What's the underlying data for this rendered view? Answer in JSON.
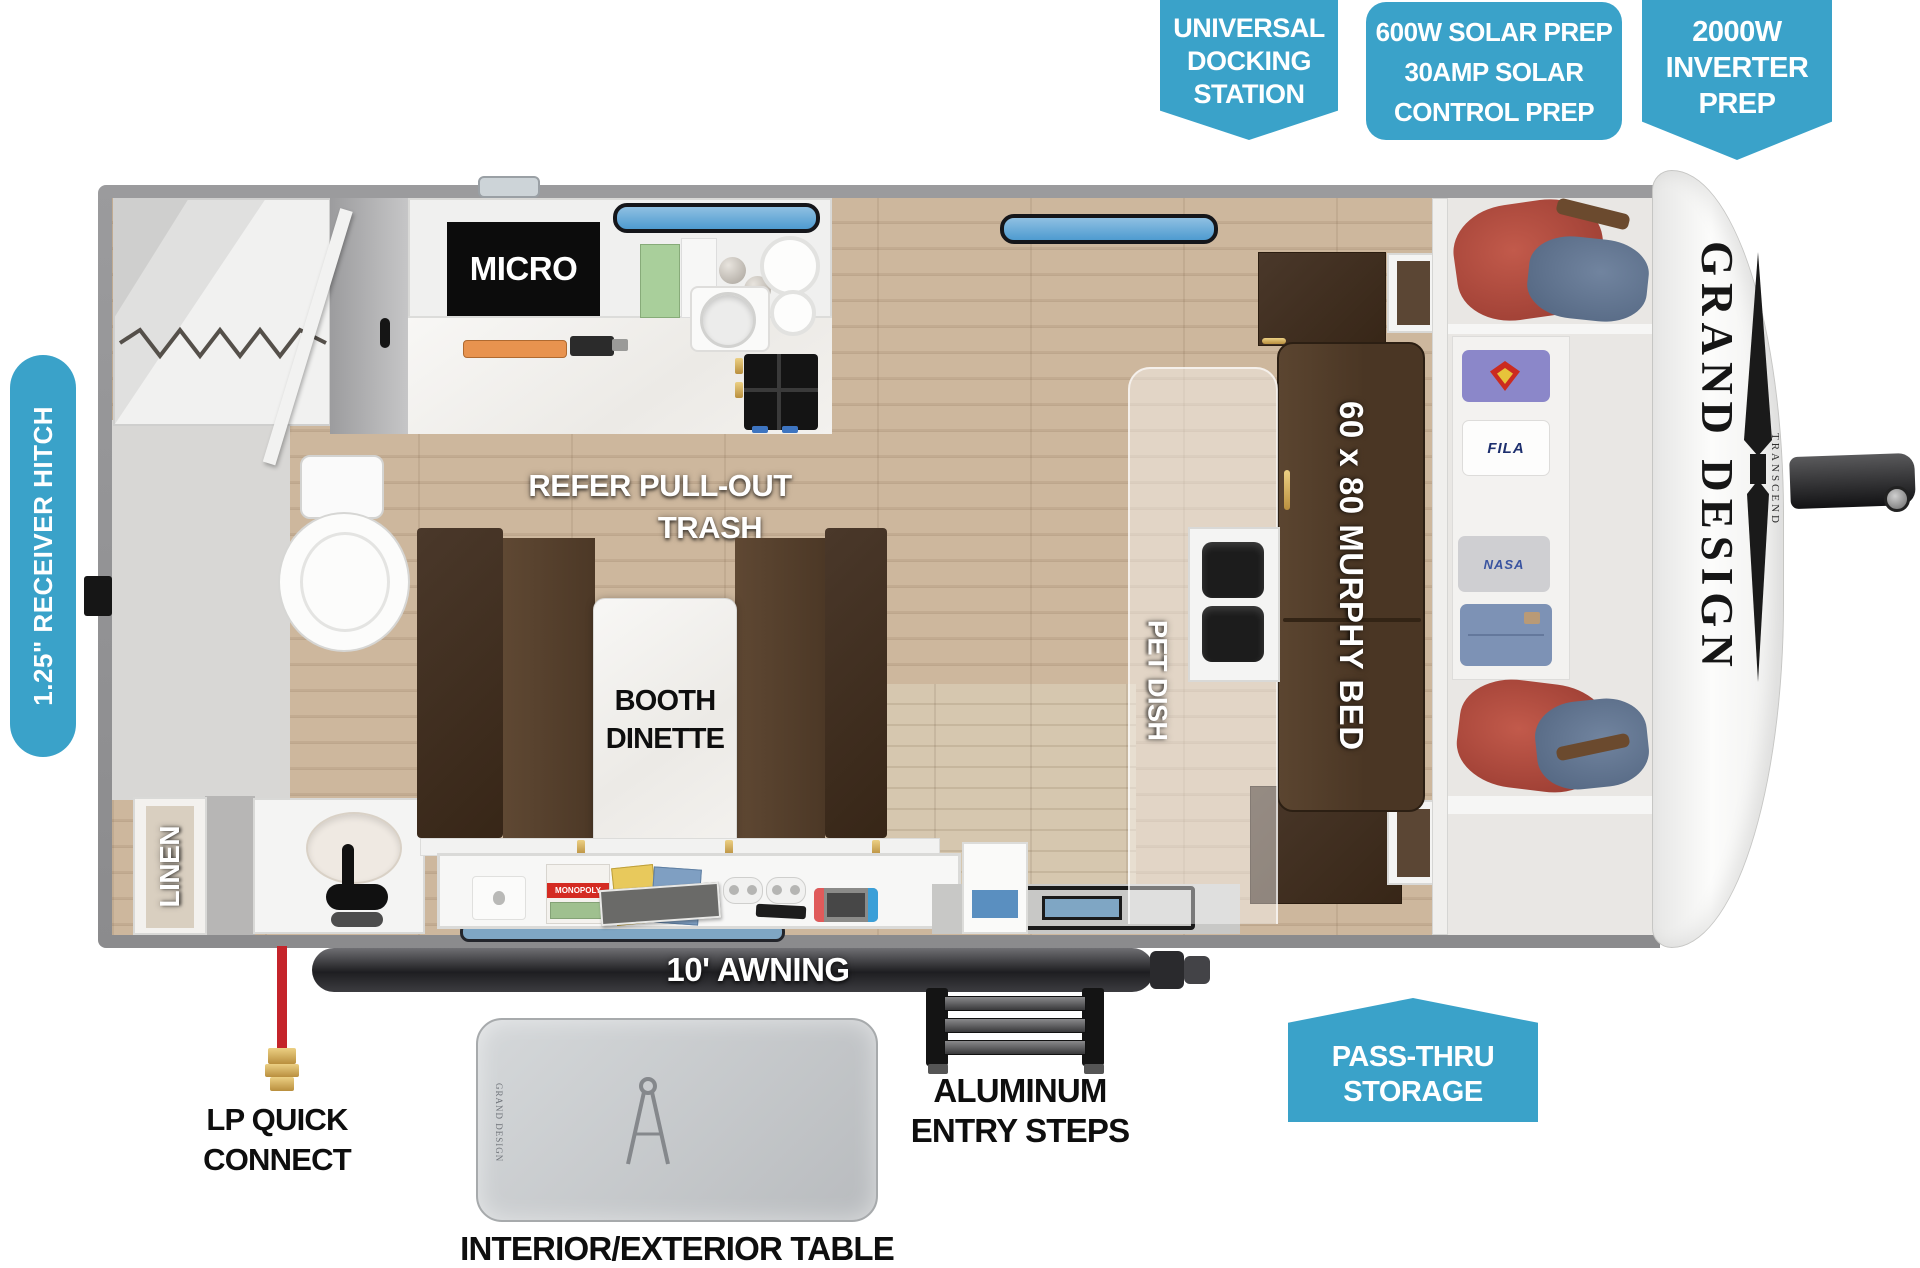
{
  "colors": {
    "callout_blue": "#3AA2C9",
    "wall_gray": "#939395",
    "wood_floor": "#c8b298",
    "bed_brown": "#4e3a27",
    "cabinet_brown": "#46331f",
    "awning_dark": "#2e2e32",
    "lp_red": "#c4242a",
    "brass": "#c9a24a"
  },
  "callouts": {
    "docking": {
      "line1": "UNIVERSAL",
      "line2": "DOCKING",
      "line3": "STATION"
    },
    "solar": {
      "line1": "600W SOLAR PREP",
      "line2": "30AMP SOLAR",
      "line3": "CONTROL PREP"
    },
    "inverter": {
      "line1": "2000W",
      "line2": "INVERTER",
      "line3": "PREP"
    },
    "receiver_hitch": "1.25\" RECEIVER HITCH",
    "pass_thru": {
      "line1": "PASS-THRU",
      "line2": "STORAGE"
    }
  },
  "interior": {
    "micro": "MICRO",
    "refer1": "REFER PULL-OUT",
    "refer2": "TRASH",
    "booth1": "BOOTH",
    "booth2": "DINETTE",
    "murphy": "60 x 80 MURPHY BED",
    "pet_dish": "PET DISH",
    "linen": "LINEN",
    "awning": "10' AWNING"
  },
  "exterior": {
    "lp1": "LP QUICK",
    "lp2": "CONNECT",
    "steps1": "ALUMINUM",
    "steps2": "ENTRY STEPS",
    "table": "INTERIOR/EXTERIOR TABLE"
  },
  "brand": {
    "logo": "GRAND DESIGN",
    "model": "TRANSCEND",
    "table_brand": "GRAND DESIGN"
  },
  "props": {
    "monopoly": "MONOPOLY",
    "fila": "FILA",
    "nasa": "NASA"
  }
}
